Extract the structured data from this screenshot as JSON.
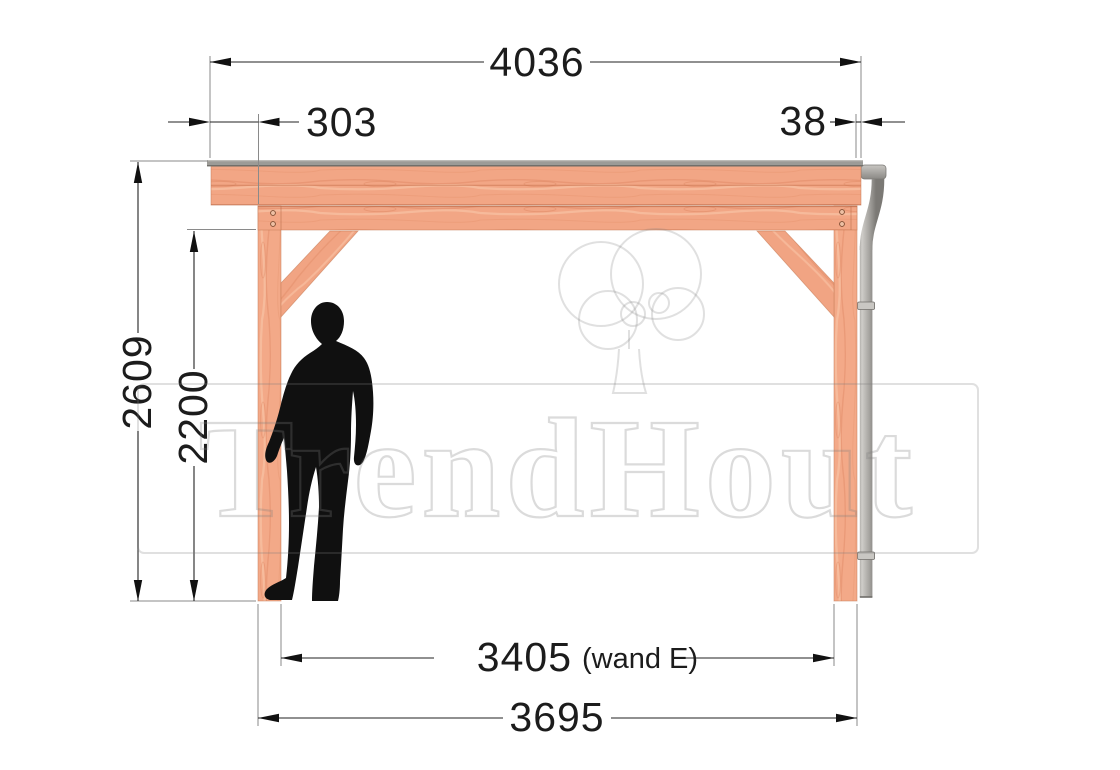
{
  "dimensions": {
    "roof_length_total": "4036",
    "overhang_left": "303",
    "overhang_right": "38",
    "height_total": "2609",
    "height_clearance": "2200",
    "wall_span": "3405",
    "wall_span_note": "(wand E)",
    "frame_width": "3695"
  },
  "watermark": {
    "brand": "TrendHout"
  },
  "colors": {
    "wood": "#f2a685",
    "wood_grain_dark": "#e18b68",
    "wood_grain_light": "#f9c3a4",
    "roof_covering": "#9c9b97",
    "gutter_pipe": "#a6a4a0",
    "dimension_line": "#1f1f1f",
    "silhouette": "#101010",
    "watermark_tint": "rgba(125,125,125,0.28)"
  }
}
